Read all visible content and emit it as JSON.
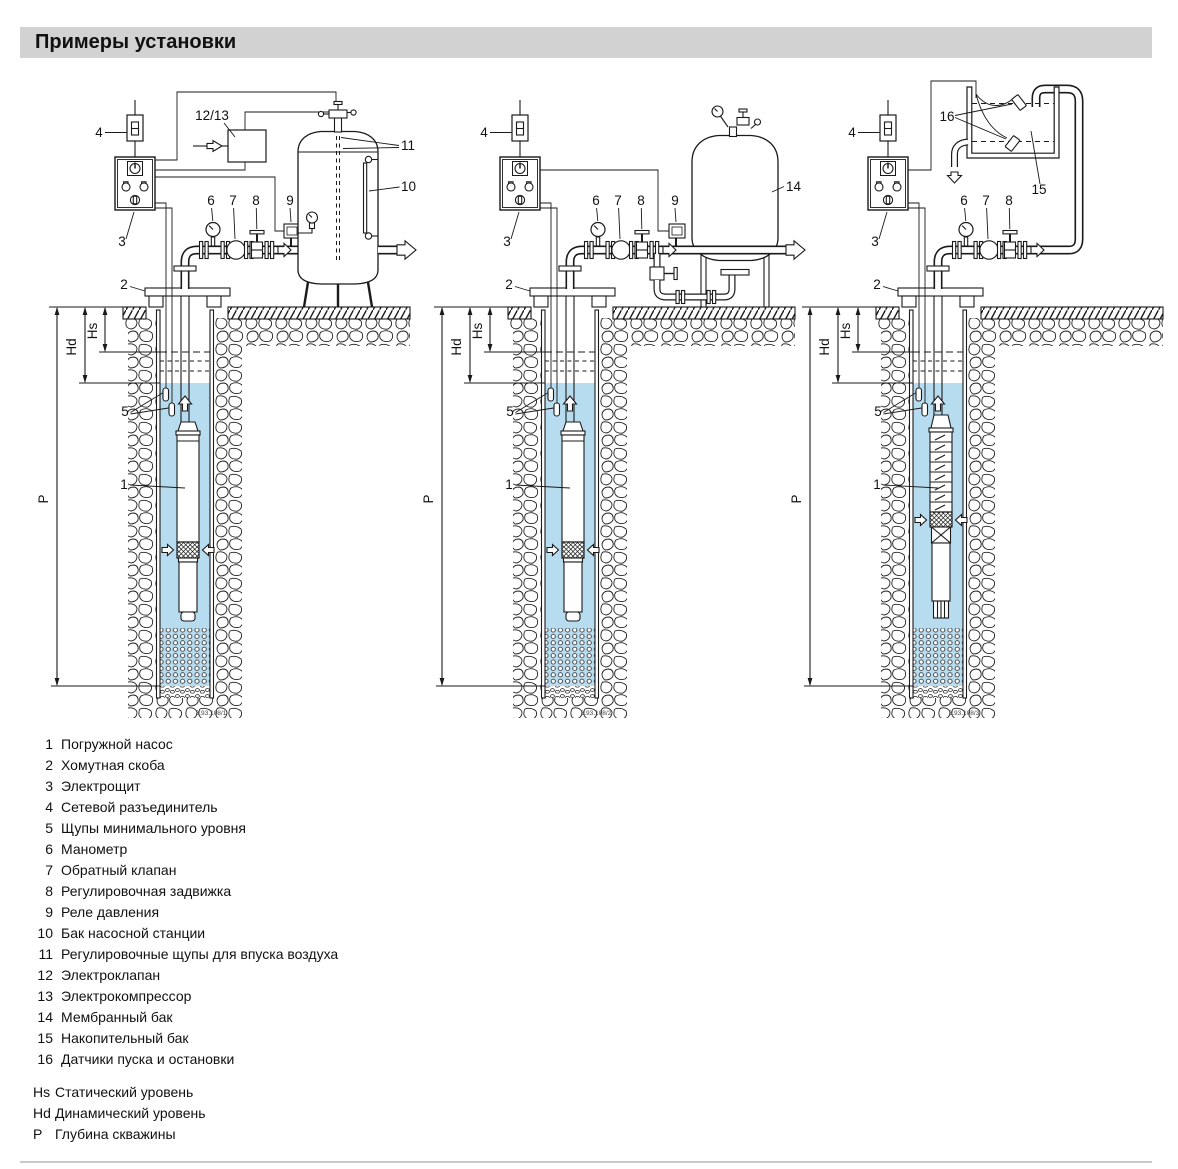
{
  "title": "Примеры установки",
  "colors": {
    "water": "#b7dcef",
    "title_bg": "#d2d2d2",
    "line": "#1a1a1a"
  },
  "diagrams": [
    {
      "figure_number": "3.93.108/1",
      "dims": {
        "hs": "Hs",
        "hd": "Hd",
        "p": "P"
      },
      "callouts": {
        "c1": "1",
        "c2": "2",
        "c3": "3",
        "c4": "4",
        "c5": "5",
        "c6": "6",
        "c7": "7",
        "c8": "8",
        "c9": "9",
        "c10": "10",
        "c11": "11",
        "c12_13": "12/13"
      }
    },
    {
      "figure_number": "3.93.108/2",
      "dims": {
        "hs": "Hs",
        "hd": "Hd",
        "p": "P"
      },
      "callouts": {
        "c1": "1",
        "c2": "2",
        "c3": "3",
        "c4": "4",
        "c5": "5",
        "c6": "6",
        "c7": "7",
        "c8": "8",
        "c9": "9",
        "c14": "14"
      }
    },
    {
      "figure_number": "3.93.108/3",
      "dims": {
        "hs": "Hs",
        "hd": "Hd",
        "p": "P"
      },
      "callouts": {
        "c1": "1",
        "c2": "2",
        "c3": "3",
        "c4": "4",
        "c5": "5",
        "c6": "6",
        "c7": "7",
        "c8": "8",
        "c15": "15",
        "c16": "16"
      }
    }
  ],
  "legend": {
    "items": [
      {
        "num": "1",
        "label": "Погружной насос"
      },
      {
        "num": "2",
        "label": "Хомутная скоба"
      },
      {
        "num": "3",
        "label": "Электрощит"
      },
      {
        "num": "4",
        "label": "Сетевой разъединитель"
      },
      {
        "num": "5",
        "label": "Щупы минимального уровня"
      },
      {
        "num": "6",
        "label": "Манометр"
      },
      {
        "num": "7",
        "label": "Обратный клапан"
      },
      {
        "num": "8",
        "label": "Регулировочная задвижка"
      },
      {
        "num": "9",
        "label": "Реле давления"
      },
      {
        "num": "10",
        "label": "Бак насосной станции"
      },
      {
        "num": "11",
        "label": "Регулировочные щупы для впуска воздуха"
      },
      {
        "num": "12",
        "label": "Электроклапан"
      },
      {
        "num": "13",
        "label": "Электрокомпрессор"
      },
      {
        "num": "14",
        "label": "Мембранный бак"
      },
      {
        "num": "15",
        "label": "Накопительный бак"
      },
      {
        "num": "16",
        "label": "Датчики пуска и остановки"
      }
    ]
  },
  "abbreviations": {
    "items": [
      {
        "key": "Hs",
        "label": "Статический уровень"
      },
      {
        "key": "Hd",
        "label": "Динамический уровень"
      },
      {
        "key": "P",
        "label": "Глубина скважины"
      }
    ]
  }
}
